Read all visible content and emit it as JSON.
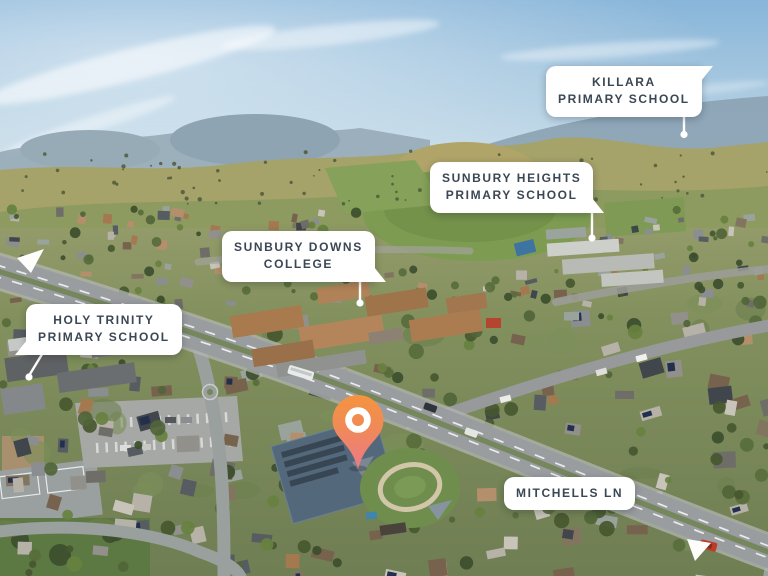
{
  "callouts": {
    "killara": {
      "line1": "KILLARA",
      "line2": "PRIMARY SCHOOL"
    },
    "sunbury_heights": {
      "line1": "SUNBURY HEIGHTS",
      "line2": "PRIMARY SCHOOL"
    },
    "sunbury_downs": {
      "line1": "SUNBURY DOWNS",
      "line2": "COLLEGE"
    },
    "holy_trinity": {
      "line1": "HOLY TRINITY",
      "line2": "PRIMARY SCHOOL"
    },
    "mitchells_ln": {
      "line1": "MITCHELLS LN"
    }
  },
  "pin": {
    "gradient_top": "#F5943E",
    "gradient_bottom": "#EC7988",
    "ring_color": "#FFFFFF"
  },
  "colors": {
    "label_text": "#3B4754",
    "label_bg": "#FFFFFF",
    "leader_line": "#FFFFFF"
  }
}
